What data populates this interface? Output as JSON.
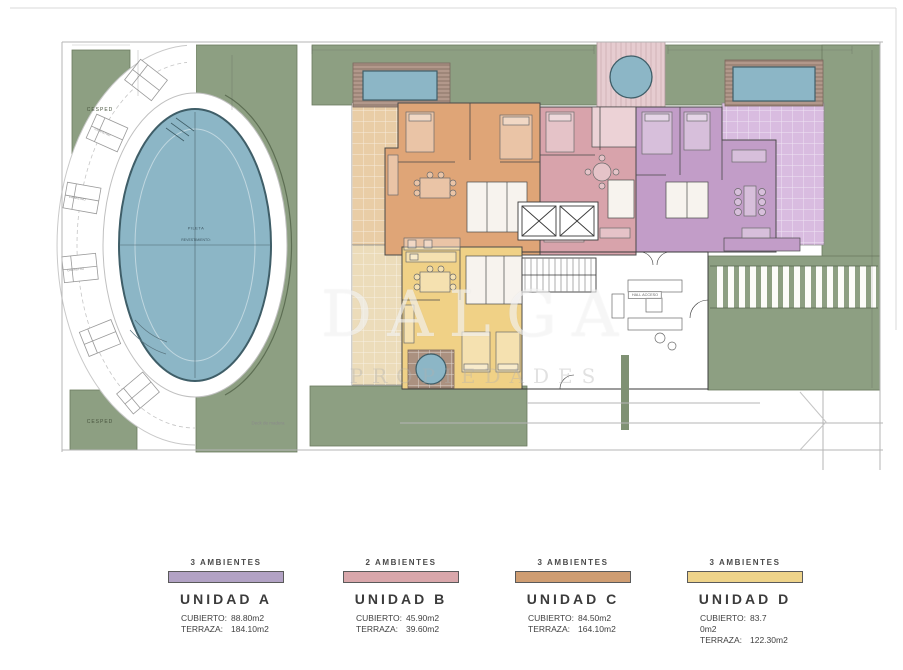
{
  "colors": {
    "grass": "#8d9f82",
    "grass_dark": "#7f9173",
    "pool": "#8cb6c6",
    "unit_a": "#c29dc8",
    "unit_a_terrace": "#d9bce0",
    "unit_b": "#d8a3ab",
    "unit_b_balcony": "#ecd2d6",
    "unit_c": "#dfa577",
    "unit_c_terrace": "#e9cda6",
    "unit_d": "#f0d186",
    "unit_d_terrace": "#ecdcba",
    "legend_a": "#b2a2c4",
    "legend_b": "#d9a7ab",
    "legend_c": "#cf9d72",
    "legend_d": "#eed38a"
  },
  "plan": {
    "labels": {
      "cesped_top": "CESPED",
      "cesped_bottom": "CESPED",
      "pileta": "PILETA",
      "revestimiento": "REVESTIMIENTO:",
      "deck_madera": "Deck de madera",
      "camastro": "CAMASTRO",
      "hall": "HALL ACCESO"
    },
    "watermark": {
      "line1": "DALGA",
      "line2": "PROPIEDADES"
    }
  },
  "legend": {
    "units": [
      {
        "ambientes": "3 AMBIENTES",
        "name": "UNIDAD A",
        "cubierto_label": "CUBIERTO:",
        "cubierto_value": "88.80m2",
        "terraza_label": "TERRAZA:",
        "terraza_value": "184.10m2",
        "color": "#b2a2c4"
      },
      {
        "ambientes": "2 AMBIENTES",
        "name": "UNIDAD B",
        "cubierto_label": "CUBIERTO:",
        "cubierto_value": "45.90m2",
        "terraza_label": "TERRAZA:",
        "terraza_value": "39.60m2",
        "color": "#d9a7ab"
      },
      {
        "ambientes": "3 AMBIENTES",
        "name": "UNIDAD C",
        "cubierto_label": "CUBIERTO:",
        "cubierto_value": "84.50m2",
        "terraza_label": "TERRAZA:",
        "terraza_value": "164.10m2",
        "color": "#cf9d72"
      },
      {
        "ambientes": "3 AMBIENTES",
        "name": "UNIDAD D",
        "cubierto_label": "CUBIERTO:",
        "cubierto_value": "83.7",
        "cubierto_overflow": "0m2",
        "terraza_label": "TERRAZA:",
        "terraza_value": "122.30m2",
        "color": "#eed38a"
      }
    ]
  }
}
